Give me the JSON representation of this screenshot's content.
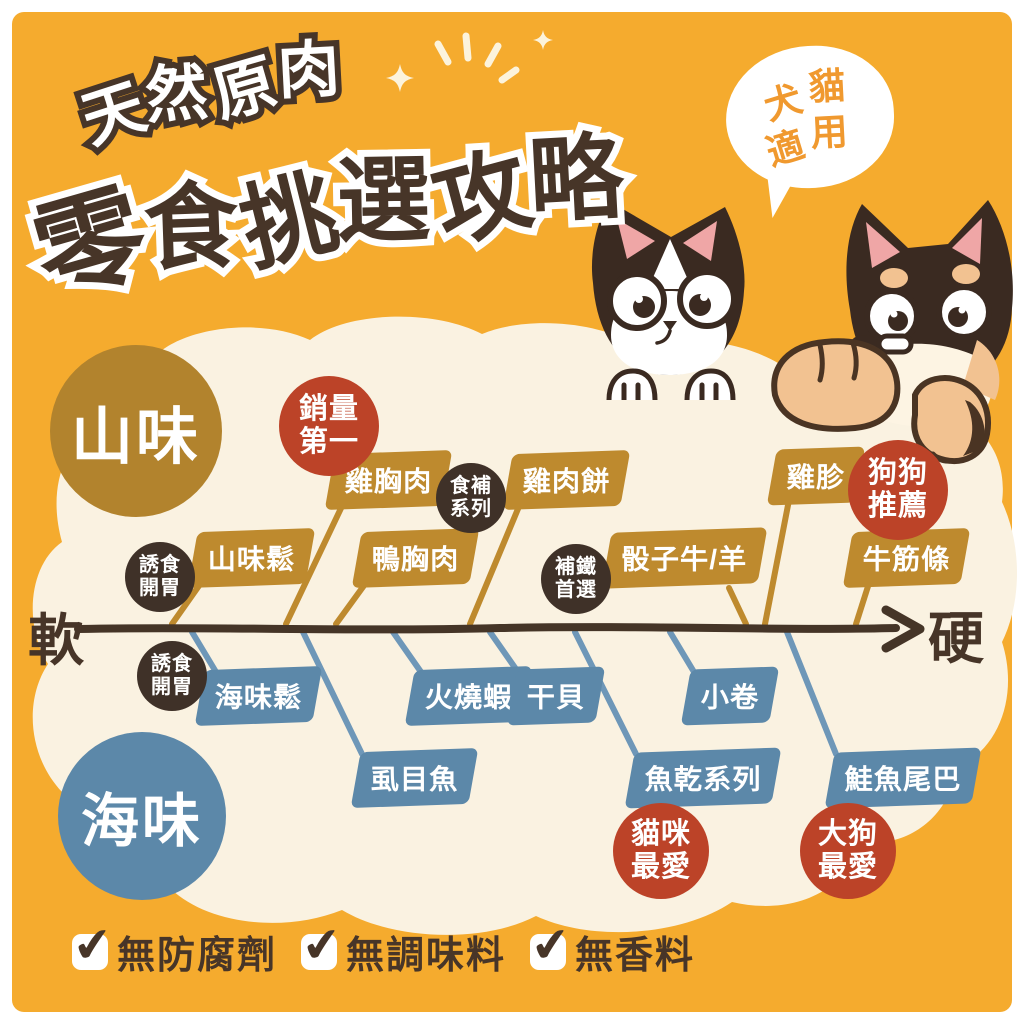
{
  "poster": {
    "title_small": "天然原肉",
    "title_main": "零食挑選攻略",
    "bubble": {
      "line1": "犬貓",
      "line2": "適用"
    },
    "axis": {
      "soft": "軟",
      "hard": "硬"
    },
    "groups": {
      "land": "山味",
      "sea": "海味"
    },
    "land_items": [
      {
        "label": "山味鬆"
      },
      {
        "label": "雞胸肉"
      },
      {
        "label": "鴨胸肉"
      },
      {
        "label": "雞肉餅"
      },
      {
        "label": "骰子牛/羊"
      },
      {
        "label": "雞胗"
      },
      {
        "label": "牛筋條"
      }
    ],
    "sea_items": [
      {
        "label": "海味鬆"
      },
      {
        "label": "虱目魚"
      },
      {
        "label": "火燒蝦"
      },
      {
        "label": "干貝"
      },
      {
        "label": "小卷"
      },
      {
        "label": "魚乾系列"
      },
      {
        "label": "鮭魚尾巴"
      }
    ],
    "badges": {
      "best_seller": {
        "line1": "銷量",
        "line2": "第一"
      },
      "nourish": {
        "line1": "食補",
        "line2": "系列"
      },
      "iron": {
        "line1": "補鐵",
        "line2": "首選"
      },
      "appetite_land": {
        "line1": "誘食",
        "line2": "開胃"
      },
      "appetite_sea": {
        "line1": "誘食",
        "line2": "開胃"
      },
      "dog_pick": {
        "line1": "狗狗",
        "line2": "推薦"
      },
      "cat_fav": {
        "line1": "貓咪",
        "line2": "最愛"
      },
      "big_dog_fav": {
        "line1": "大狗",
        "line2": "最愛"
      }
    },
    "footer": [
      {
        "label": "無防腐劑"
      },
      {
        "label": "無調味料"
      },
      {
        "label": "無香料"
      }
    ],
    "colors": {
      "background": "#F5AB2E",
      "cloud": "#FAF2E1",
      "land_flag": "#BE8A2E",
      "land_circle": "#B2832D",
      "sea_flag": "#5C88A9",
      "red_badge": "#BC4328",
      "dark_badge": "#3F3128",
      "ink": "#473528",
      "bubble_text": "#F0992F"
    }
  }
}
